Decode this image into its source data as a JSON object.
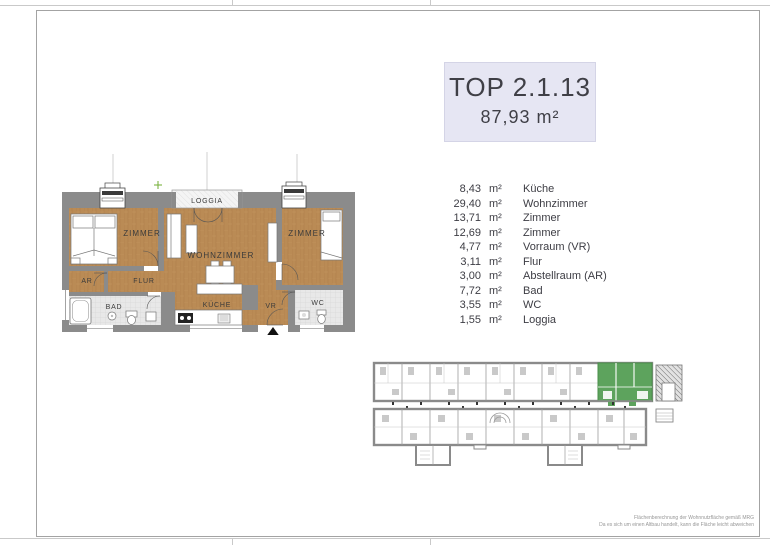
{
  "title": {
    "unit_id": "TOP 2.1.13",
    "total_area": "87,93 m²"
  },
  "rooms": [
    {
      "area": "8,43",
      "unit": "m²",
      "name": "Küche"
    },
    {
      "area": "29,40",
      "unit": "m²",
      "name": "Wohnzimmer"
    },
    {
      "area": "13,71",
      "unit": "m²",
      "name": "Zimmer"
    },
    {
      "area": "12,69",
      "unit": "m²",
      "name": "Zimmer"
    },
    {
      "area": "4,77",
      "unit": "m²",
      "name": "Vorraum (VR)"
    },
    {
      "area": "3,11",
      "unit": "m²",
      "name": "Flur"
    },
    {
      "area": "3,00",
      "unit": "m²",
      "name": "Abstellraum (AR)"
    },
    {
      "area": "7,72",
      "unit": "m²",
      "name": "Bad"
    },
    {
      "area": "3,55",
      "unit": "m²",
      "name": "WC"
    },
    {
      "area": "1,55",
      "unit": "m²",
      "name": "Loggia"
    }
  ],
  "plan_labels": {
    "zimmer_left": "ZIMMER",
    "zimmer_right": "ZIMMER",
    "wohnzimmer": "WOHNZIMMER",
    "kueche": "KÜCHE",
    "flur": "FLUR",
    "ar": "AR",
    "bad": "BAD",
    "vr": "VR",
    "wc": "WC",
    "loggia": "LOGGIA"
  },
  "footnote": {
    "line1": "Flächenberechnung der Wohnnutzfläche gemäß MRG",
    "line2": "Da es sich um einen Altbau handelt, kann die Fläche leicht abweichen"
  },
  "colors": {
    "title_bg": "#e6e6f3",
    "wood": "#ba8b55",
    "wall_gray": "#8b8b8b",
    "tile": "#e8e8e8",
    "highlight_green": "#5da35d",
    "entrance_marker": "#111111"
  }
}
